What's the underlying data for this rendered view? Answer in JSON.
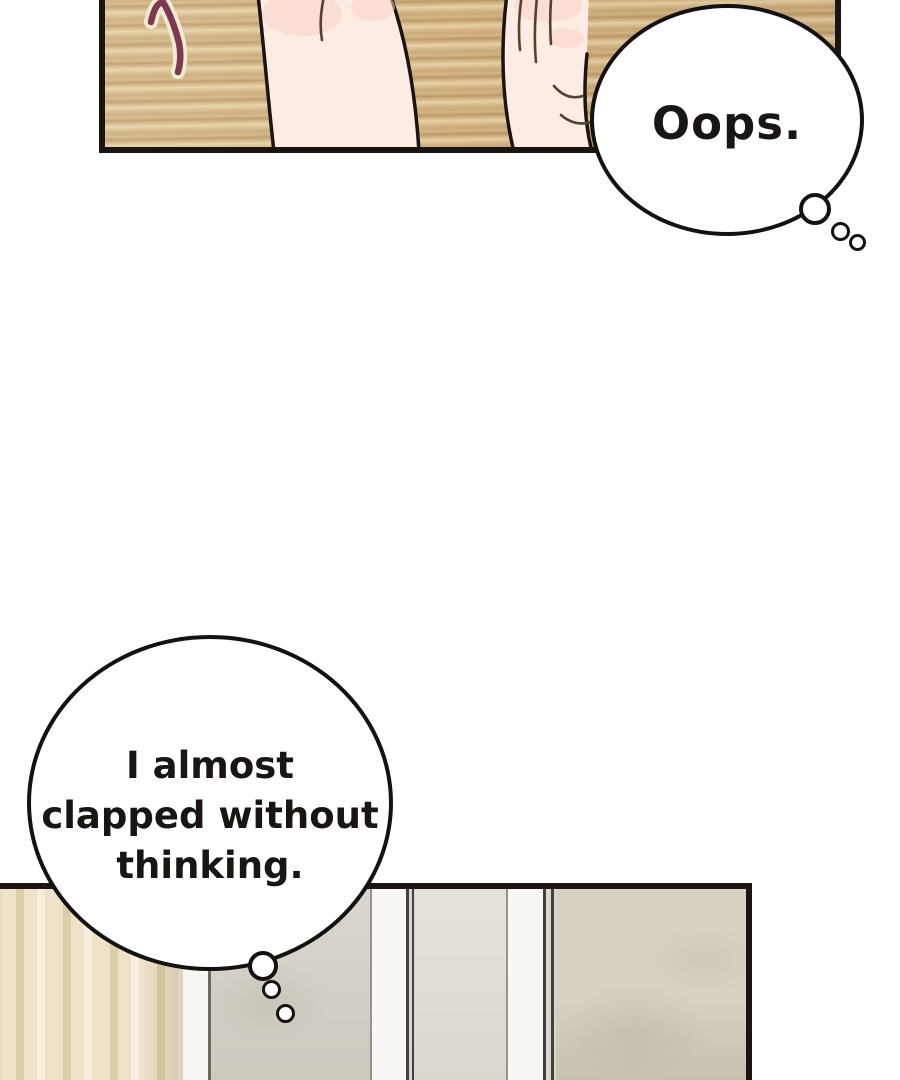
{
  "comic": {
    "bubbles": {
      "oops": {
        "text": "Oops."
      },
      "thought": {
        "line1": "I almost",
        "line2": "clapped without",
        "line3": "thinking."
      }
    }
  },
  "colors": {
    "ink": "#1b1512",
    "bubble-border": "#141210",
    "text-ink": "#181512",
    "wood-base": "#d5b787",
    "wood-light": "#e6d2a6",
    "wood-dark": "#c9aa78",
    "wood-deep": "#bd9a68",
    "skin": "#fdece4",
    "skin-shadow": "#f7d2c5",
    "skin-line": "#54412f",
    "hair-strand": "#7c3a50",
    "strand-outline": "#f3ead2",
    "curtain-base": "#eee3c9",
    "curtain-shadow": "#decdaa",
    "curtain-light": "#f6efdd",
    "strip-white": "#f8f7f3",
    "wall-gray": "#dad7d0",
    "wall-gray-dark": "#ccc8be",
    "wall-light": "#e5e2db",
    "wall-beige": "#d7d1c3",
    "wall-beige-dark": "#c6beab",
    "line-dark": "#45403a",
    "line-soft": "#6e6960",
    "line-faint": "#9a9486"
  }
}
